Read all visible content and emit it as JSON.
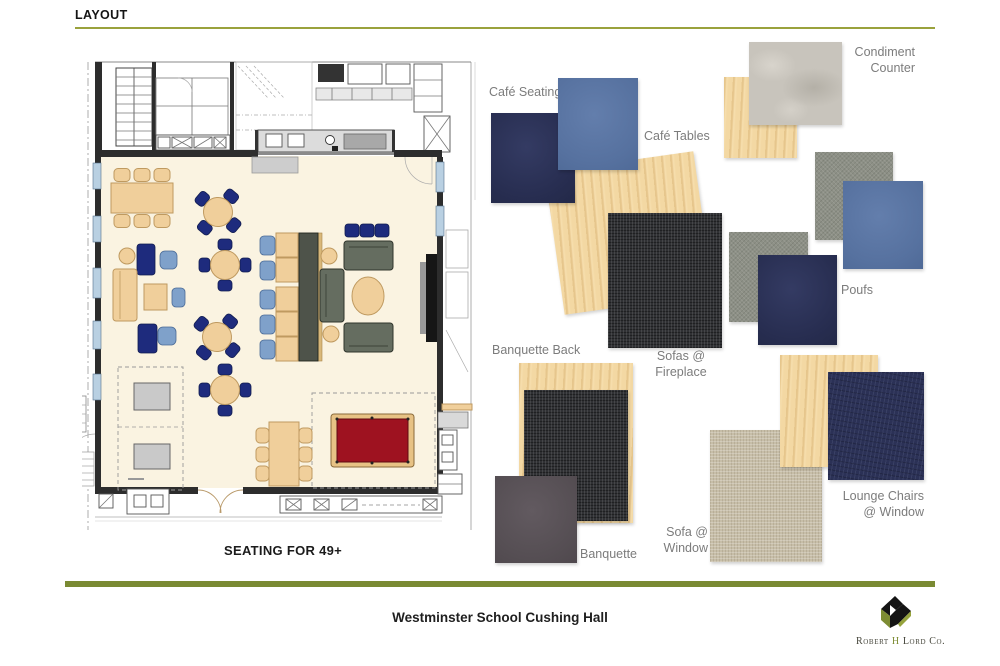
{
  "header": {
    "title": "LAYOUT",
    "underline_color": "#9aa23c"
  },
  "plan": {
    "caption": "SEATING FOR 49+",
    "up_label": "UP",
    "colors": {
      "floor": "#faf3e1",
      "wall": "#2d2d2d",
      "wood_furniture": "#f0cf9b",
      "navy_chair": "#1e2b7d",
      "light_blue_chair": "#7fa1ca",
      "sofa_gray": "#656d60",
      "pool_table_felt": "#9e1220",
      "game_table": "#c9c9c9",
      "window": "#b9d0e2"
    }
  },
  "materials": {
    "cafe_seating": {
      "label": "Café Seating",
      "swatches": [
        {
          "name": "navy upholstery",
          "color": "#272d50"
        },
        {
          "name": "blue upholstery",
          "color": "#56719f"
        }
      ]
    },
    "cafe_tables": {
      "label": "Café Tables",
      "swatches": [
        {
          "name": "maple wood",
          "color": "#f3d8a3"
        }
      ]
    },
    "condiment_counter": {
      "label": "Condiment\nCounter",
      "swatches": [
        {
          "name": "maple wood",
          "color": "#f3d8a3"
        },
        {
          "name": "gray stone",
          "color": "#c8c4bc"
        }
      ]
    },
    "poufs": {
      "label": "Poufs",
      "swatches": [
        {
          "name": "gray felt",
          "color": "#8d9086"
        },
        {
          "name": "blue upholstery",
          "color": "#56719f"
        },
        {
          "name": "gray felt",
          "color": "#8d9086"
        },
        {
          "name": "navy upholstery",
          "color": "#272d50"
        }
      ]
    },
    "sofas_fireplace": {
      "label": "Sofas @\nFireplace",
      "swatches": [
        {
          "name": "charcoal tweed",
          "color": "#303134"
        }
      ]
    },
    "banquette_back": {
      "label": "Banquette Back",
      "swatches": [
        {
          "name": "maple wood",
          "color": "#f3d8a3"
        },
        {
          "name": "charcoal tweed",
          "color": "#303134"
        }
      ]
    },
    "banquette": {
      "label": "Banquette",
      "swatches": [
        {
          "name": "dark gray leather",
          "color": "#554e53"
        }
      ]
    },
    "sofa_window": {
      "label": "Sofa @\nWindow",
      "swatches": [
        {
          "name": "beige linen",
          "color": "#c7bea8"
        }
      ]
    },
    "lounge_chairs": {
      "label": "Lounge Chairs\n@ Window",
      "swatches": [
        {
          "name": "maple wood",
          "color": "#f3d8a3"
        },
        {
          "name": "navy denim",
          "color": "#2b3156"
        }
      ]
    }
  },
  "footer": {
    "rule_color": "#7a8a33",
    "title": "Westminster School Cushing Hall",
    "logo": {
      "part1": "Robert",
      "accent": "H",
      "part2": "Lord Co."
    }
  }
}
